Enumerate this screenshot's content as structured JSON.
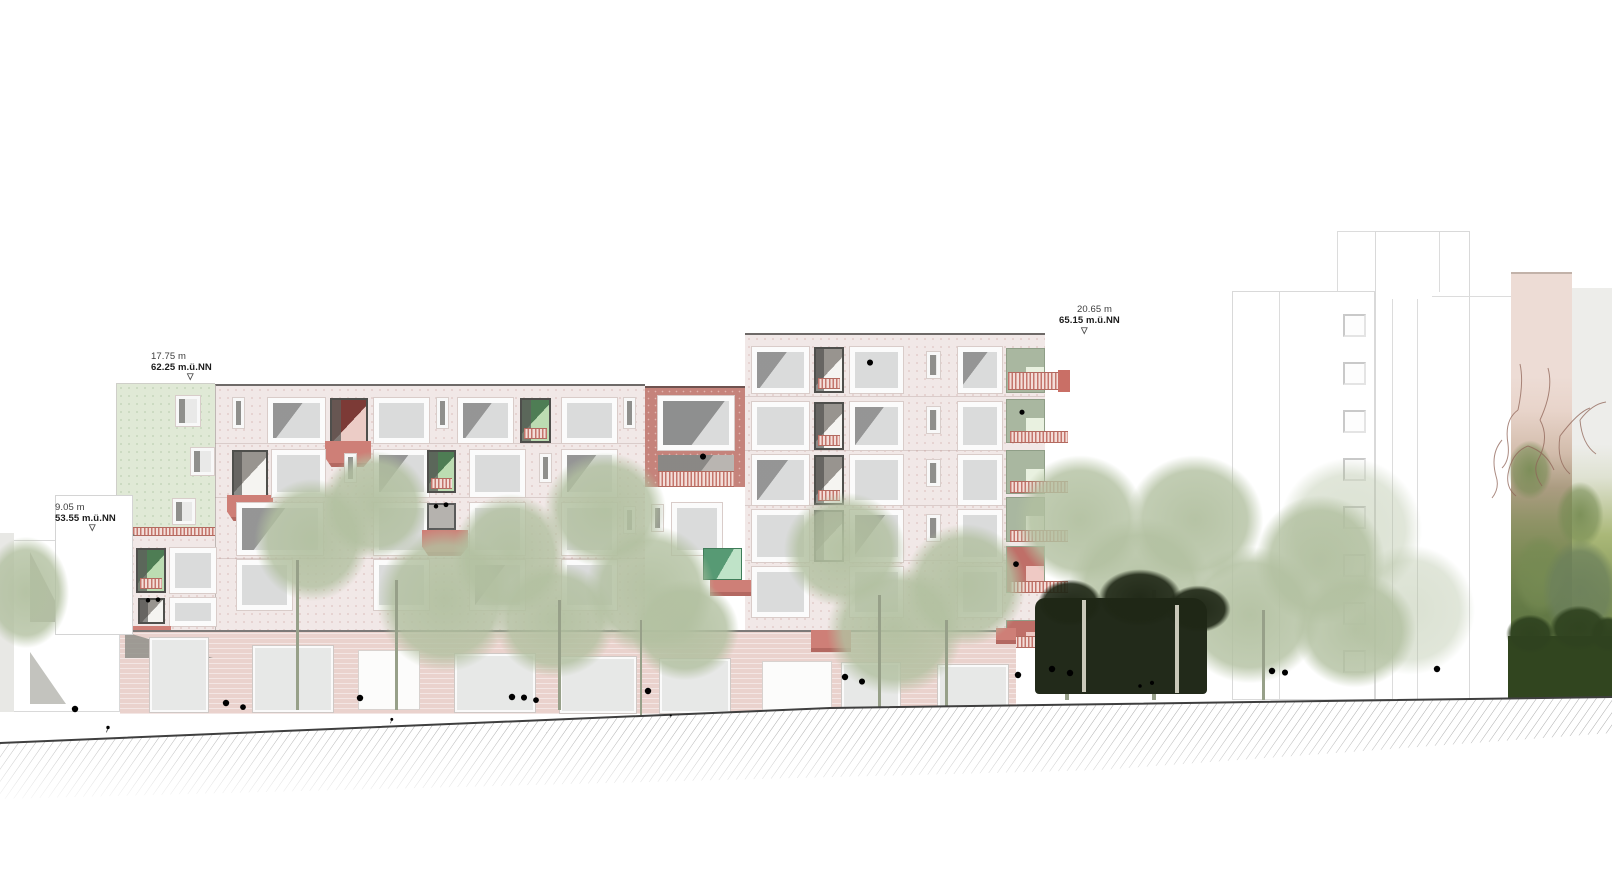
{
  "annotations": [
    {
      "id": "annex-roof-level",
      "height": "17.75 m",
      "level": "62.25 m.ü.NN"
    },
    {
      "id": "lower-ref-level",
      "height": "9.05 m",
      "level": "53.55 m.ü.NN"
    },
    {
      "id": "tower-roof-level",
      "height": "20.65 m",
      "level": "65.15 m.ü.NN"
    }
  ],
  "icons": {
    "level_marker": "▽"
  },
  "palette": {
    "facade_pink": "#f1e8e7",
    "facade_green_annex": "#e0e9d6",
    "accent_terracotta": "#c5837b",
    "balcony_red": "#ce7f77",
    "dark_red_loggia": "#7c3a36",
    "loggia_green": "#4e7d54",
    "loggia_light_green": "#bcdcb2",
    "tower_loggia_sage": "#a9b7a0",
    "emerald_door": "#579a74",
    "window_glass": "#dadbdb",
    "window_frame": "#fbfbfb",
    "ground_floor_pink": "#ead2cd",
    "tree_sage": "#b2c0a0",
    "tree_dark": "#1f2716",
    "hedge_green": "#2f4220",
    "ivy_green": "#768b53",
    "ivy_wall_beige": "#ecdbd3",
    "outline_grey": "#d9d9d9",
    "ground_line": "#3f3f3f",
    "hatch_grey": "#ababab"
  }
}
